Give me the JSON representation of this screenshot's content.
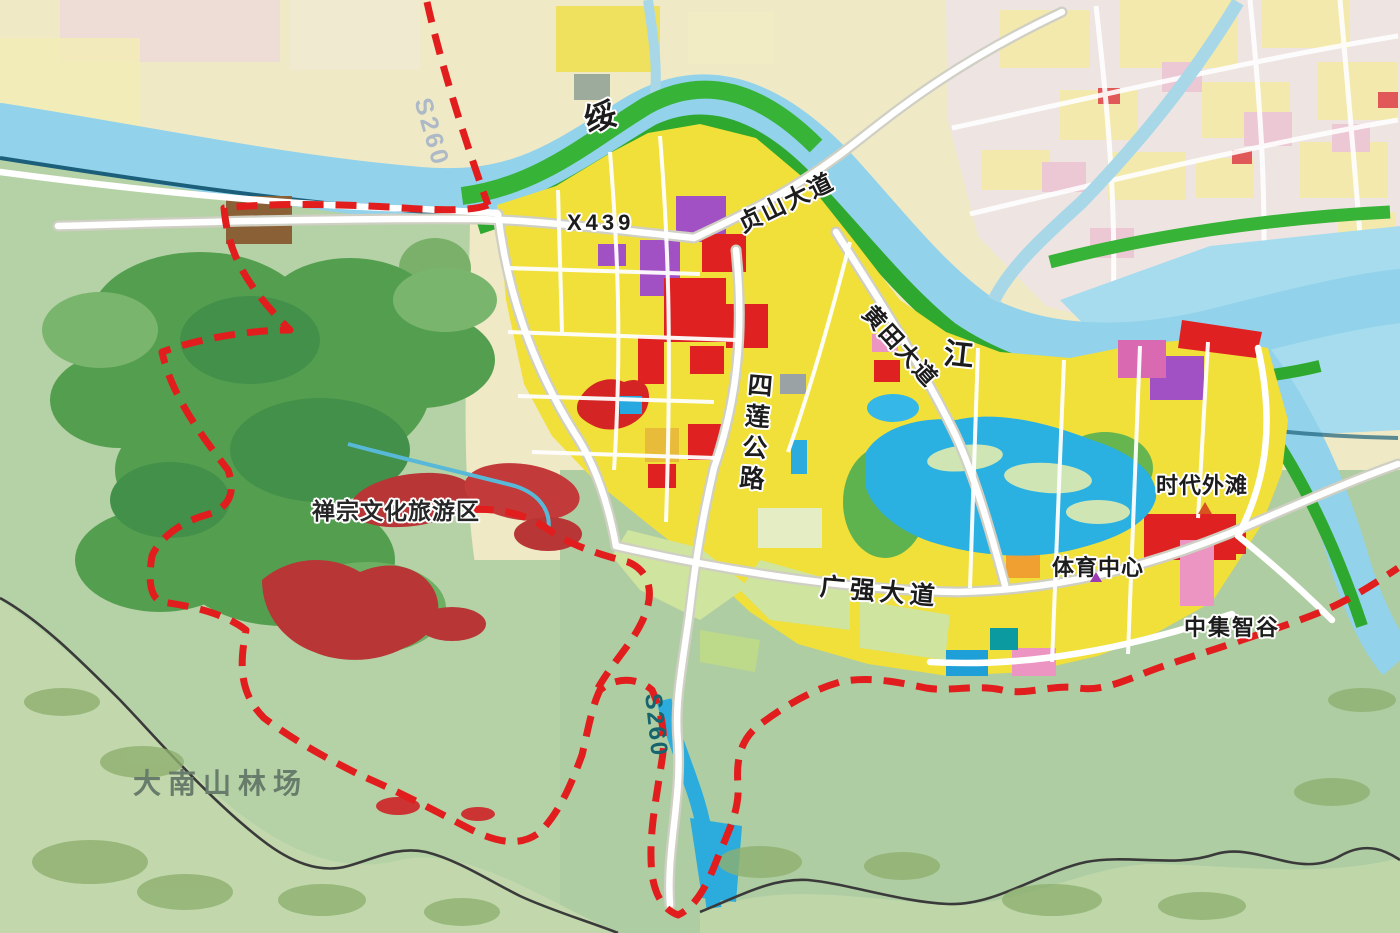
{
  "map": {
    "kind": "urban land-use planning map",
    "water_labels": {
      "sui": {
        "text": "绥"
      },
      "jiang": {
        "text": "江"
      }
    },
    "road_labels": {
      "s260_north": {
        "text": "S260"
      },
      "s260_south": {
        "text": "S260"
      },
      "x439": {
        "text": "X439"
      },
      "zhenshan_avenue": {
        "text": "贞山大道"
      },
      "huangtian_avenue": {
        "text": "黄田大道"
      },
      "silian_highway": {
        "text": "四莲公路"
      },
      "guangqiang_avenue": {
        "text": "广强大道"
      }
    },
    "area_labels": {
      "zen_culture_tourism": {
        "text": "禅宗文化旅游区"
      },
      "times_bund": {
        "text": "时代外滩",
        "marker": "orange-triangle"
      },
      "sports_center": {
        "text": "体育中心",
        "marker": "purple-triangle"
      },
      "cimc_smart_valley": {
        "text": "中集智谷"
      },
      "danan_forest_farm": {
        "text": "大南山林场"
      }
    },
    "colors": {
      "boundary_dashed_red": "#e21d1d",
      "river_blue": "#92d2ea",
      "lake_blue": "#2bb0e2",
      "greenbelt": "#35b335",
      "hill_green": "#549f4f",
      "plain_green": "#b5d1a6",
      "parcel_yellow": "#f1df3a",
      "parcel_red": "#df2121",
      "parcel_crimson": "#b83636",
      "parcel_purple": "#a151c4",
      "parcel_pink": "#ec95c2",
      "parcel_orange": "#f0a030",
      "parcel_lightgreen": "#cfe49e",
      "road_white": "#ffffff",
      "admin_line_black": "#3a3a3a",
      "old_city_base": "#eee4e2"
    }
  }
}
